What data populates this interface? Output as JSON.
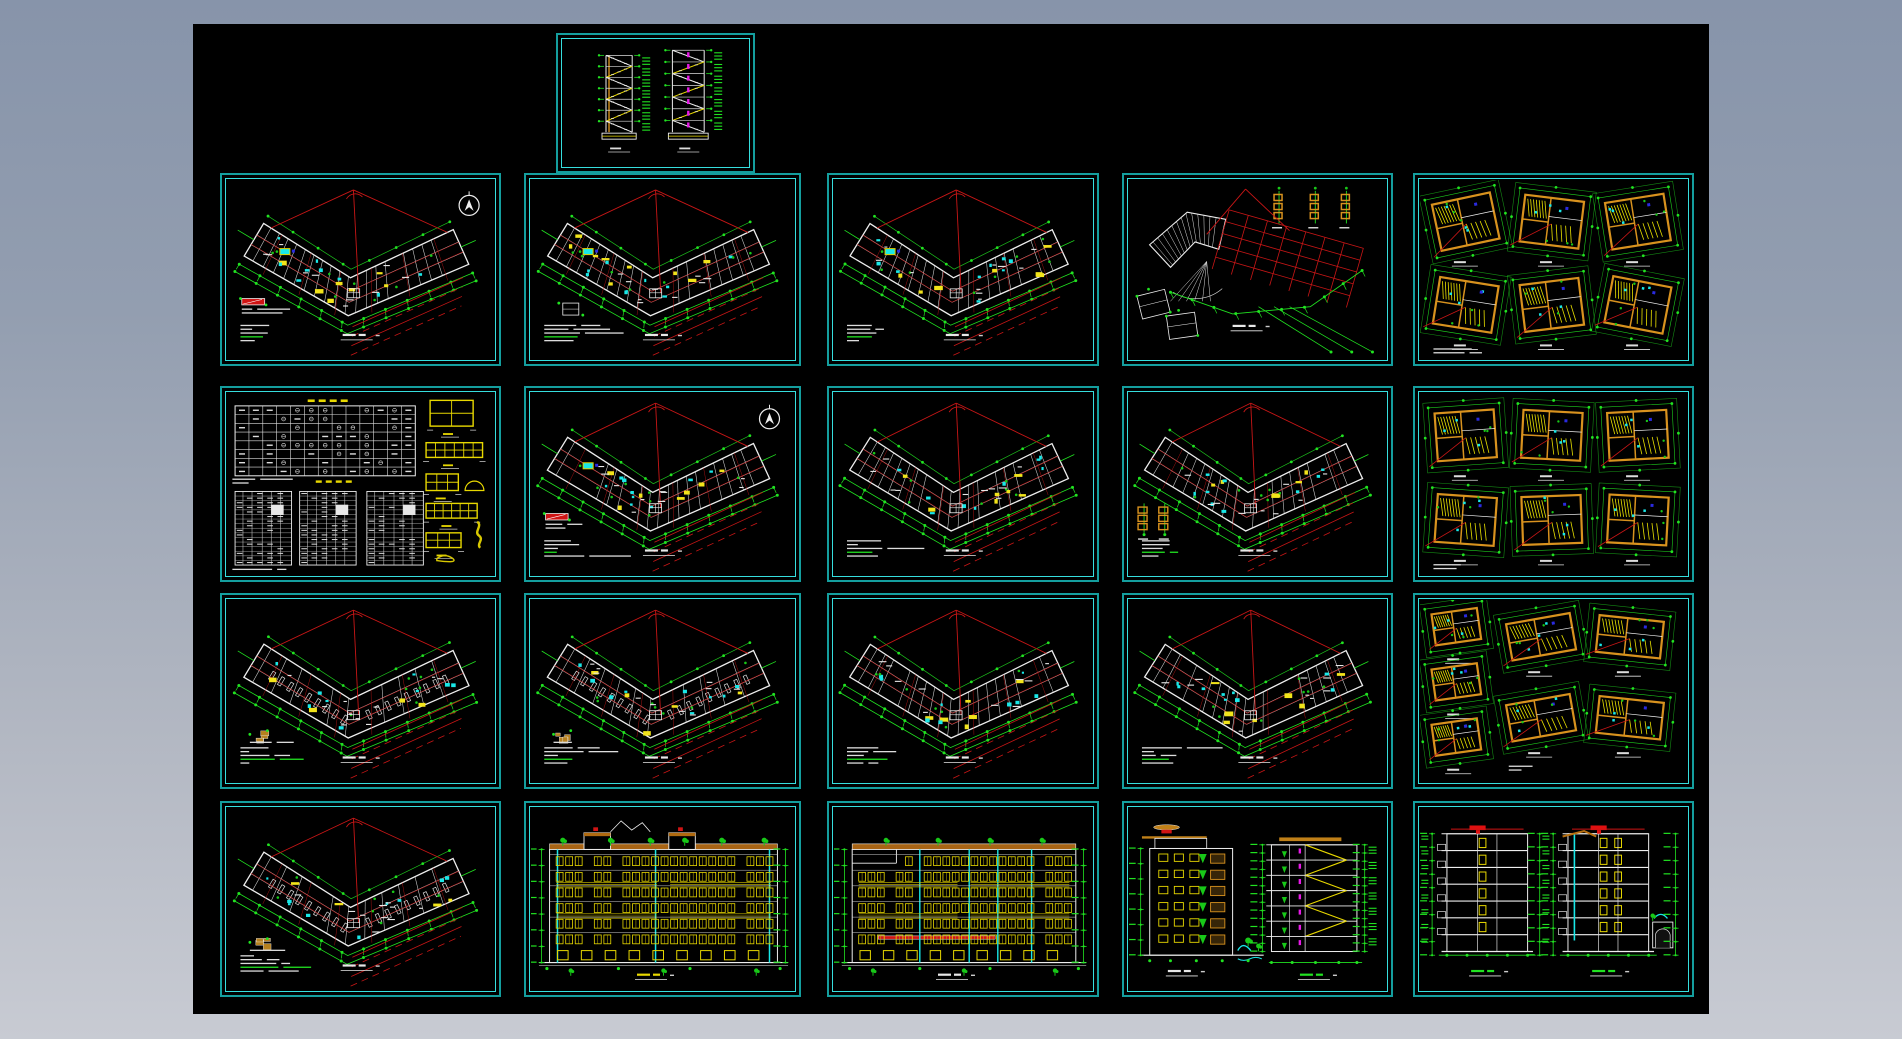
{
  "app": {
    "kind": "cad-drawing-set-preview",
    "background_top": "#8794aa",
    "background_bottom": "#c8cbd3",
    "canvas_color": "#000000"
  },
  "canvas": {
    "x": 193,
    "y": 24,
    "width": 1516,
    "height": 990
  },
  "palette": {
    "border_outer": "#149e9e",
    "border_inner": "#36dede",
    "dim_green": "#21e321",
    "grid_red": "#c81616",
    "wall_white": "#eeeeee",
    "accent_yellow": "#f2e41a",
    "detail_orange": "#d8921e",
    "accent_cyan": "#19e8e8",
    "accent_magenta": "#e819e8",
    "roof_brown": "#a86414",
    "canopy_red": "#d01414",
    "deep_blue": "#2a2ae0"
  },
  "frames": [
    {
      "name": "stair-sections-sheet",
      "type": "stairs",
      "x": 363,
      "y": 9,
      "w": 199,
      "h": 140,
      "seed": 11,
      "opts": {}
    },
    {
      "name": "floor-plan-sheet-1",
      "type": "plan",
      "x": 27,
      "y": 149,
      "w": 281,
      "h": 193,
      "seed": 21,
      "opts": {
        "north": 1,
        "legend": 1,
        "pool": 1,
        "yellow": 0.55,
        "notes": 1
      }
    },
    {
      "name": "floor-plan-sheet-2",
      "type": "plan",
      "x": 331,
      "y": 149,
      "w": 277,
      "h": 193,
      "seed": 22,
      "opts": {
        "pool": 1,
        "yellow": 0.85,
        "detail": 1,
        "notes": 1
      }
    },
    {
      "name": "floor-plan-sheet-3",
      "type": "plan",
      "x": 634,
      "y": 149,
      "w": 272,
      "h": 193,
      "seed": 23,
      "opts": {
        "pool": 1,
        "yellow": 0.5,
        "notes": 1
      }
    },
    {
      "name": "roof-plan-sheet",
      "type": "roof",
      "x": 929,
      "y": 149,
      "w": 271,
      "h": 193,
      "seed": 24,
      "opts": {}
    },
    {
      "name": "unit-detail-plans-sheet-1",
      "type": "units",
      "x": 1220,
      "y": 149,
      "w": 281,
      "h": 193,
      "seed": 25,
      "opts": {
        "layout": "a",
        "notes": 1
      }
    },
    {
      "name": "schedule-table-sheet",
      "type": "schedule",
      "x": 27,
      "y": 362,
      "w": 281,
      "h": 196,
      "seed": 26,
      "opts": {}
    },
    {
      "name": "floor-plan-sheet-4",
      "type": "plan",
      "x": 331,
      "y": 362,
      "w": 277,
      "h": 196,
      "seed": 27,
      "opts": {
        "north": 1,
        "legend": 1,
        "pool": 1,
        "yellow": 0.6,
        "notes": 1
      }
    },
    {
      "name": "floor-plan-sheet-5",
      "type": "plan",
      "x": 634,
      "y": 362,
      "w": 272,
      "h": 196,
      "seed": 28,
      "opts": {
        "yellow": 0.5,
        "notes": 1
      }
    },
    {
      "name": "floor-plan-sheet-6",
      "type": "plan",
      "x": 929,
      "y": 362,
      "w": 271,
      "h": 196,
      "seed": 29,
      "opts": {
        "yellow": 0.45,
        "gear": 1,
        "notes": 1
      }
    },
    {
      "name": "unit-detail-plans-sheet-2",
      "type": "units",
      "x": 1220,
      "y": 362,
      "w": 281,
      "h": 196,
      "seed": 30,
      "opts": {
        "layout": "b",
        "notes": 1
      }
    },
    {
      "name": "parking-plan-sheet-1",
      "type": "plan",
      "x": 27,
      "y": 569,
      "w": 281,
      "h": 196,
      "seed": 31,
      "opts": {
        "stalls": 1,
        "yellow": 0.15,
        "brown": 1,
        "notes": 1
      }
    },
    {
      "name": "parking-plan-sheet-2",
      "type": "plan",
      "x": 331,
      "y": 569,
      "w": 277,
      "h": 196,
      "seed": 32,
      "opts": {
        "stalls": 1,
        "yellow": 0.3,
        "brown": 1,
        "notes": 1
      }
    },
    {
      "name": "floor-plan-sheet-7",
      "type": "plan",
      "x": 634,
      "y": 569,
      "w": 272,
      "h": 196,
      "seed": 33,
      "opts": {
        "yellow": 0.4,
        "notes": 1
      }
    },
    {
      "name": "floor-plan-sheet-8",
      "type": "plan",
      "x": 929,
      "y": 569,
      "w": 271,
      "h": 196,
      "seed": 34,
      "opts": {
        "yellow": 0.5,
        "notes": 1
      }
    },
    {
      "name": "unit-detail-plans-sheet-3",
      "type": "units",
      "x": 1220,
      "y": 569,
      "w": 281,
      "h": 196,
      "seed": 35,
      "opts": {
        "layout": "c",
        "notes": 1
      }
    },
    {
      "name": "parking-plan-sheet-3",
      "type": "plan",
      "x": 27,
      "y": 777,
      "w": 281,
      "h": 196,
      "seed": 36,
      "opts": {
        "stalls": 1,
        "yellow": 0.15,
        "brown": 1,
        "notes": 1
      }
    },
    {
      "name": "front-elevation-sheet",
      "type": "elevation",
      "x": 331,
      "y": 777,
      "w": 277,
      "h": 196,
      "seed": 37,
      "opts": {
        "variant": "front"
      }
    },
    {
      "name": "rear-elevation-sheet",
      "type": "elevation",
      "x": 634,
      "y": 777,
      "w": 272,
      "h": 196,
      "seed": 38,
      "opts": {
        "variant": "rear"
      }
    },
    {
      "name": "side-elevation-and-section-sheet",
      "type": "elevsec",
      "x": 929,
      "y": 777,
      "w": 271,
      "h": 196,
      "seed": 39,
      "opts": {}
    },
    {
      "name": "building-sections-sheet",
      "type": "sections",
      "x": 1220,
      "y": 777,
      "w": 281,
      "h": 196,
      "seed": 40,
      "opts": {}
    }
  ]
}
